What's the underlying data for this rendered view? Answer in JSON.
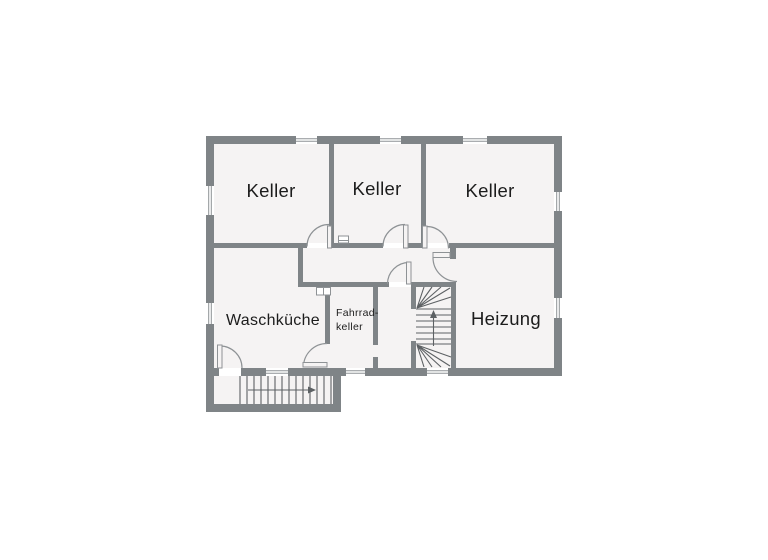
{
  "plan": {
    "type": "floorplan",
    "colors": {
      "wall": "#7f8487",
      "room": "#f5f3f3",
      "line": "#8e9295",
      "stair": "#5d6164",
      "text": "#1c1c1c",
      "bg": "#ffffff"
    },
    "rooms": [
      {
        "id": "keller-1",
        "label": "Keller"
      },
      {
        "id": "keller-2",
        "label": "Keller"
      },
      {
        "id": "keller-3",
        "label": "Keller"
      },
      {
        "id": "waschkueche",
        "label": "Waschküche"
      },
      {
        "id": "fahrradkeller",
        "label_lines": [
          "Fahrrad-",
          "keller"
        ]
      },
      {
        "id": "heizung",
        "label": "Heizung"
      }
    ],
    "stairs": [
      {
        "id": "internal-winder-stairs",
        "direction_icon": "arrow-up-icon"
      },
      {
        "id": "external-basement-stairs",
        "direction_icon": "arrow-right-icon"
      }
    ],
    "window_count": 9,
    "door_count": 7
  }
}
